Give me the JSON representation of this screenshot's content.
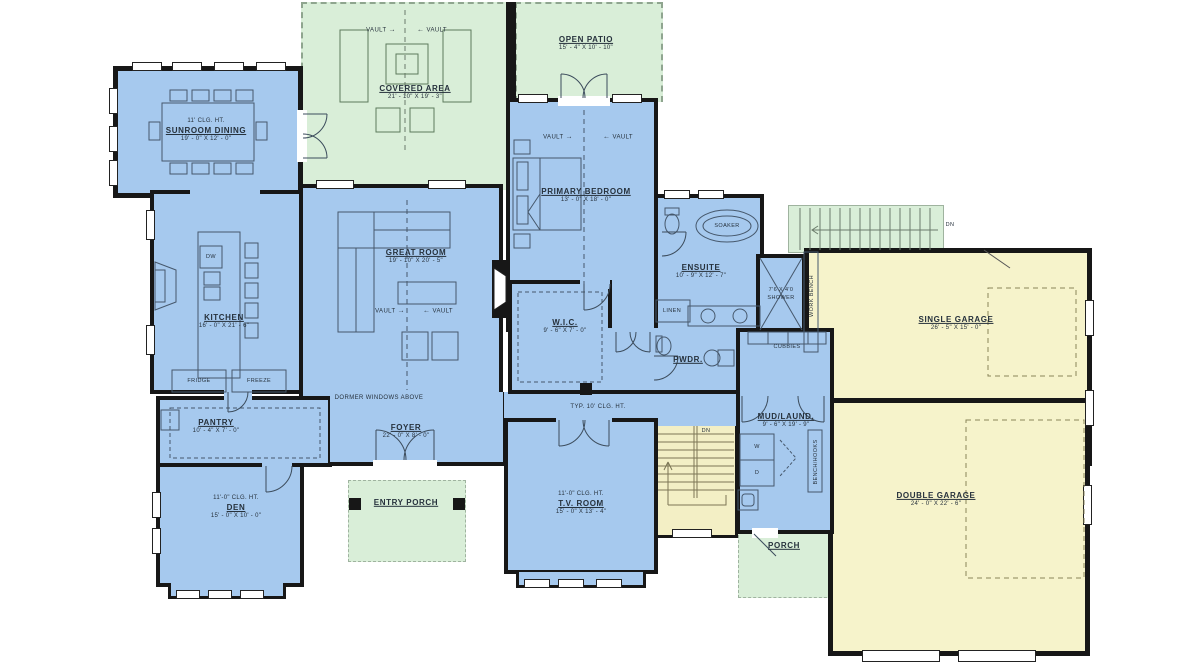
{
  "colors": {
    "room_blue": "#a6c9ee",
    "outdoor_green": "#d9eed8",
    "garage_yellow": "#f6f3cb",
    "wall": "#171717"
  },
  "rooms": {
    "sunroom": {
      "clg": "11' CLG. HT.",
      "name": "SUNROOM DINING",
      "dims": "19' - 0\" X 12' - 0\""
    },
    "covered_area": {
      "name": "COVERED AREA",
      "dims": "21' - 10\" X 19' - 3\""
    },
    "open_patio": {
      "name": "OPEN PATIO",
      "dims": "15' - 4\" X 10' - 10\""
    },
    "primary_bedroom": {
      "name": "PRIMARY BEDROOM",
      "dims": "13' - 0\" X 18' - 0\""
    },
    "great_room": {
      "name": "GREAT ROOM",
      "dims": "19' - 10\" X 20' - 5\""
    },
    "kitchen": {
      "name": "KITCHEN",
      "dims": "16' - 0\" X 21' - 6\""
    },
    "ensuite": {
      "name": "ENSUITE",
      "dims": "10' - 9\" X 12' - 7\""
    },
    "wic": {
      "name": "W.I.C.",
      "dims": "9' - 6\" X 7' - 0\""
    },
    "pwdr": {
      "name": "PWDR."
    },
    "pantry": {
      "name": "PANTRY",
      "dims": "10' - 4\" X 7' - 0\""
    },
    "foyer": {
      "name": "FOYER",
      "dims": "22' - 0\" X 8' - 0\""
    },
    "den": {
      "clg": "11'-0\" CLG. HT.",
      "name": "DEN",
      "dims": "15' - 0\" X 10' - 0\""
    },
    "entry_porch": {
      "name": "ENTRY PORCH"
    },
    "tv_room": {
      "clg": "11'-0\" CLG. HT.",
      "name": "T.V. ROOM",
      "dims": "15' - 0\" X 13' - 4\""
    },
    "mud_laund": {
      "name": "MUD/LAUND.",
      "dims": "9' - 6\" X 19' - 9\""
    },
    "porch": {
      "name": "PORCH"
    },
    "single_garage": {
      "name": "SINGLE GARAGE",
      "dims": "26' - 5\" X 15' - 0\""
    },
    "double_garage": {
      "name": "DOUBLE GARAGE",
      "dims": "24' - 0\" X 22' - 6\""
    }
  },
  "annotations": {
    "vault": "VAULT",
    "arrow_r": "→",
    "arrow_l": "←",
    "dn": "DN",
    "dormer": "DORMER WINDOWS ABOVE",
    "typ_clg": "TYP. 10' CLG. HT.",
    "linen": "LINEN",
    "cubbies": "CUBBIES",
    "bench_hooks": "BENCH/HOOKS",
    "work_bench": "WORK BENCH",
    "soaker": "SOAKER",
    "shower_size": "7'6 X 4'0",
    "shower": "SHOWER",
    "fridge": "FRIDGE",
    "freeze": "FREEZE",
    "dw": "DW",
    "washer": "W",
    "dryer": "D"
  }
}
